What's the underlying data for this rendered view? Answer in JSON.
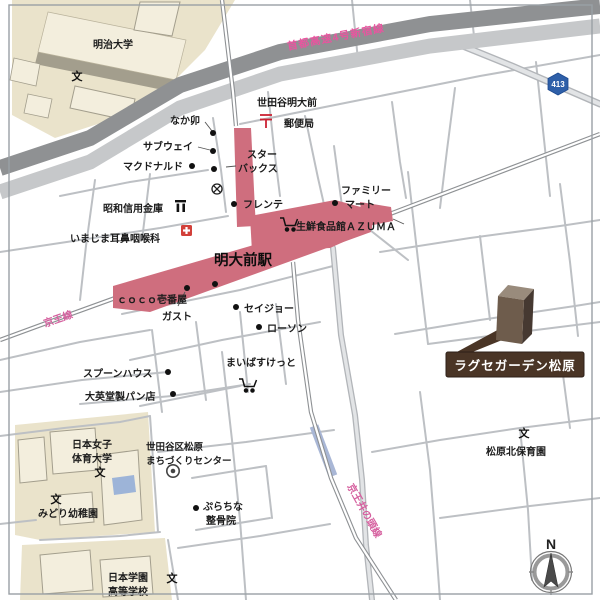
{
  "property": {
    "name": "ラグセガーデン松原"
  },
  "station": {
    "name": "明大前駅"
  },
  "rail_lines": {
    "keio": "京王線",
    "inokashira": "京王井の頭線",
    "expressway": "首都高速4号新宿線"
  },
  "road_shield": {
    "route_number": "413"
  },
  "compass": {
    "north_label": "N"
  },
  "marks": {
    "school": "文",
    "post": "〒"
  },
  "pois": {
    "meiji_university": "明治大学",
    "post_office_line1": "世田谷明大前",
    "post_office_line2": "郵便局",
    "nakau": "なか卯",
    "subway": "サブウェイ",
    "mcdonalds": "マクドナルド",
    "starbucks_line1": "スター",
    "starbucks_line2": "バックス",
    "frente": "フレンテ",
    "showa_shinkin_bank": "昭和信用金庫",
    "imajima_ent_clinic": "いまじま耳鼻咽喉科",
    "familymart_line1": "ファミリー",
    "familymart_line2": "マート",
    "azuma_market": "生鮮食品館ＡＺＵＭＡ",
    "coco_ichibanya": "ｃｏｃｏ壱番屋",
    "gusto": "ガスト",
    "seijo": "セイジョー",
    "lawson": "ローソン",
    "maibasket": "まいばすけっと",
    "spoon_house": "スプーンハウス",
    "daieido_bakery": "大英堂製パン店",
    "nwcpe_line1": "日本女子",
    "nwcpe_line2": "体育大学",
    "machizukuri_line1": "世田谷区松原",
    "machizukuri_line2": "まちづくりセンター",
    "purachina_line1": "ぷらちな",
    "purachina_line2": "整骨院",
    "midori_kindergarten": "みどり幼稚園",
    "nihongakuen_line1": "日本学園",
    "nihongakuen_line2": "高等学校",
    "matsubara_kita_nursery": "松原北保育園"
  },
  "colors": {
    "station_pink": "#cf6e7e",
    "rail_label_pink": "#d55f9e",
    "expressway_dark": "#8f9193",
    "road_light": "#c6c8ca",
    "campus_beige": "#eae3cb",
    "marker_brown": "#4a3526",
    "shield_blue": "#2e5fa8",
    "pool_blue": "#9db4d8"
  }
}
